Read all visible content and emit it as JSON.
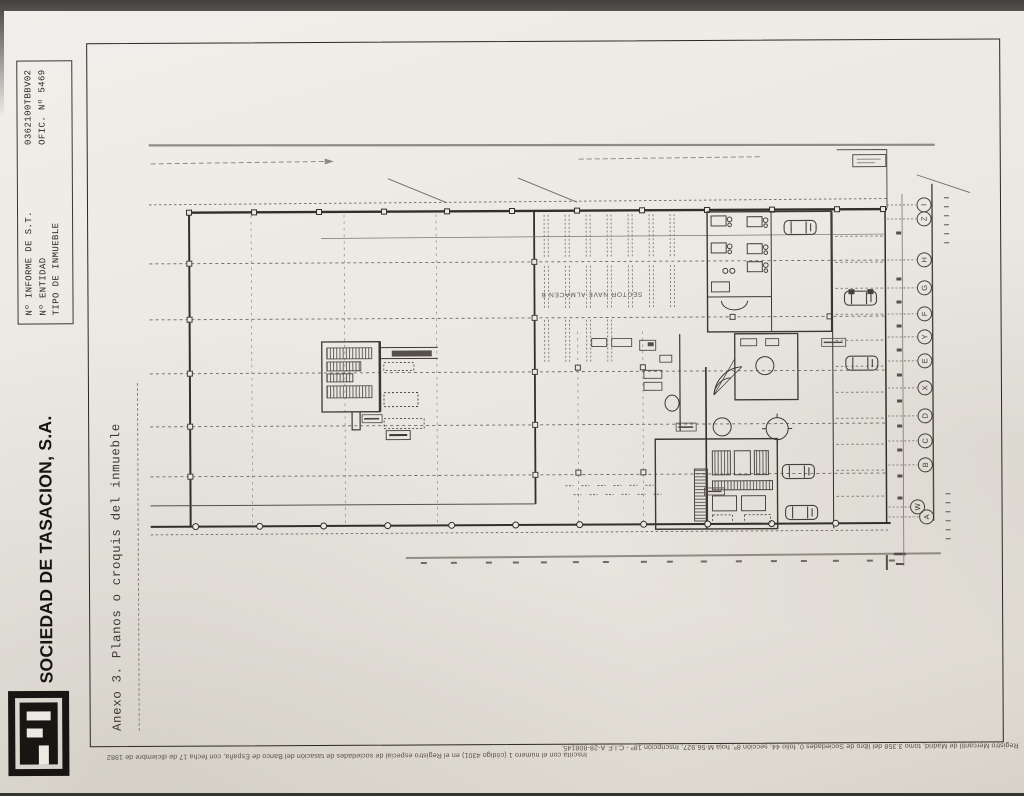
{
  "report_stamp": {
    "rows": [
      {
        "label": "Nº INFORME DE S.T.",
        "value": "0362100TBBV02"
      },
      {
        "label": "Nº ENTIDAD",
        "value": "OFIC. Nº 5469"
      },
      {
        "label": "TIPO DE INMUEBLE",
        "value": ""
      }
    ]
  },
  "brand": {
    "company_name": "SOCIEDAD DE TASACION, S.A."
  },
  "annex": {
    "title": "Anexo 3. Planos o croquis del inmueble"
  },
  "floor_plan": {
    "sector_label": "SECTOR NAVE ALMACEN B",
    "axis_bubbles": [
      "I",
      "Z",
      "H",
      "G",
      "F",
      "Y",
      "E",
      "X",
      "D",
      "C",
      "B",
      "W",
      "A"
    ]
  },
  "footer": {
    "registry_line_left": "Inscrita con el número 1 (código 4301) en el Registro especial de sociedades de tasación del Banco de España, con fecha 17 de diciembre de 1982",
    "registry_line_right": "Registro Mercantil de Madrid, tomo 3.358 del libro de Sociedades 0, folio 44, sección 8ª, hoja M-56.927, Inscripción 18ª - C.I.F. A-28-808145."
  },
  "colors": {
    "paper": "#ece9e3",
    "ink": "#1d1a16",
    "plan_line": "#413d36",
    "plan_light": "#8f8b83",
    "scan_edge": "#403f3c"
  }
}
